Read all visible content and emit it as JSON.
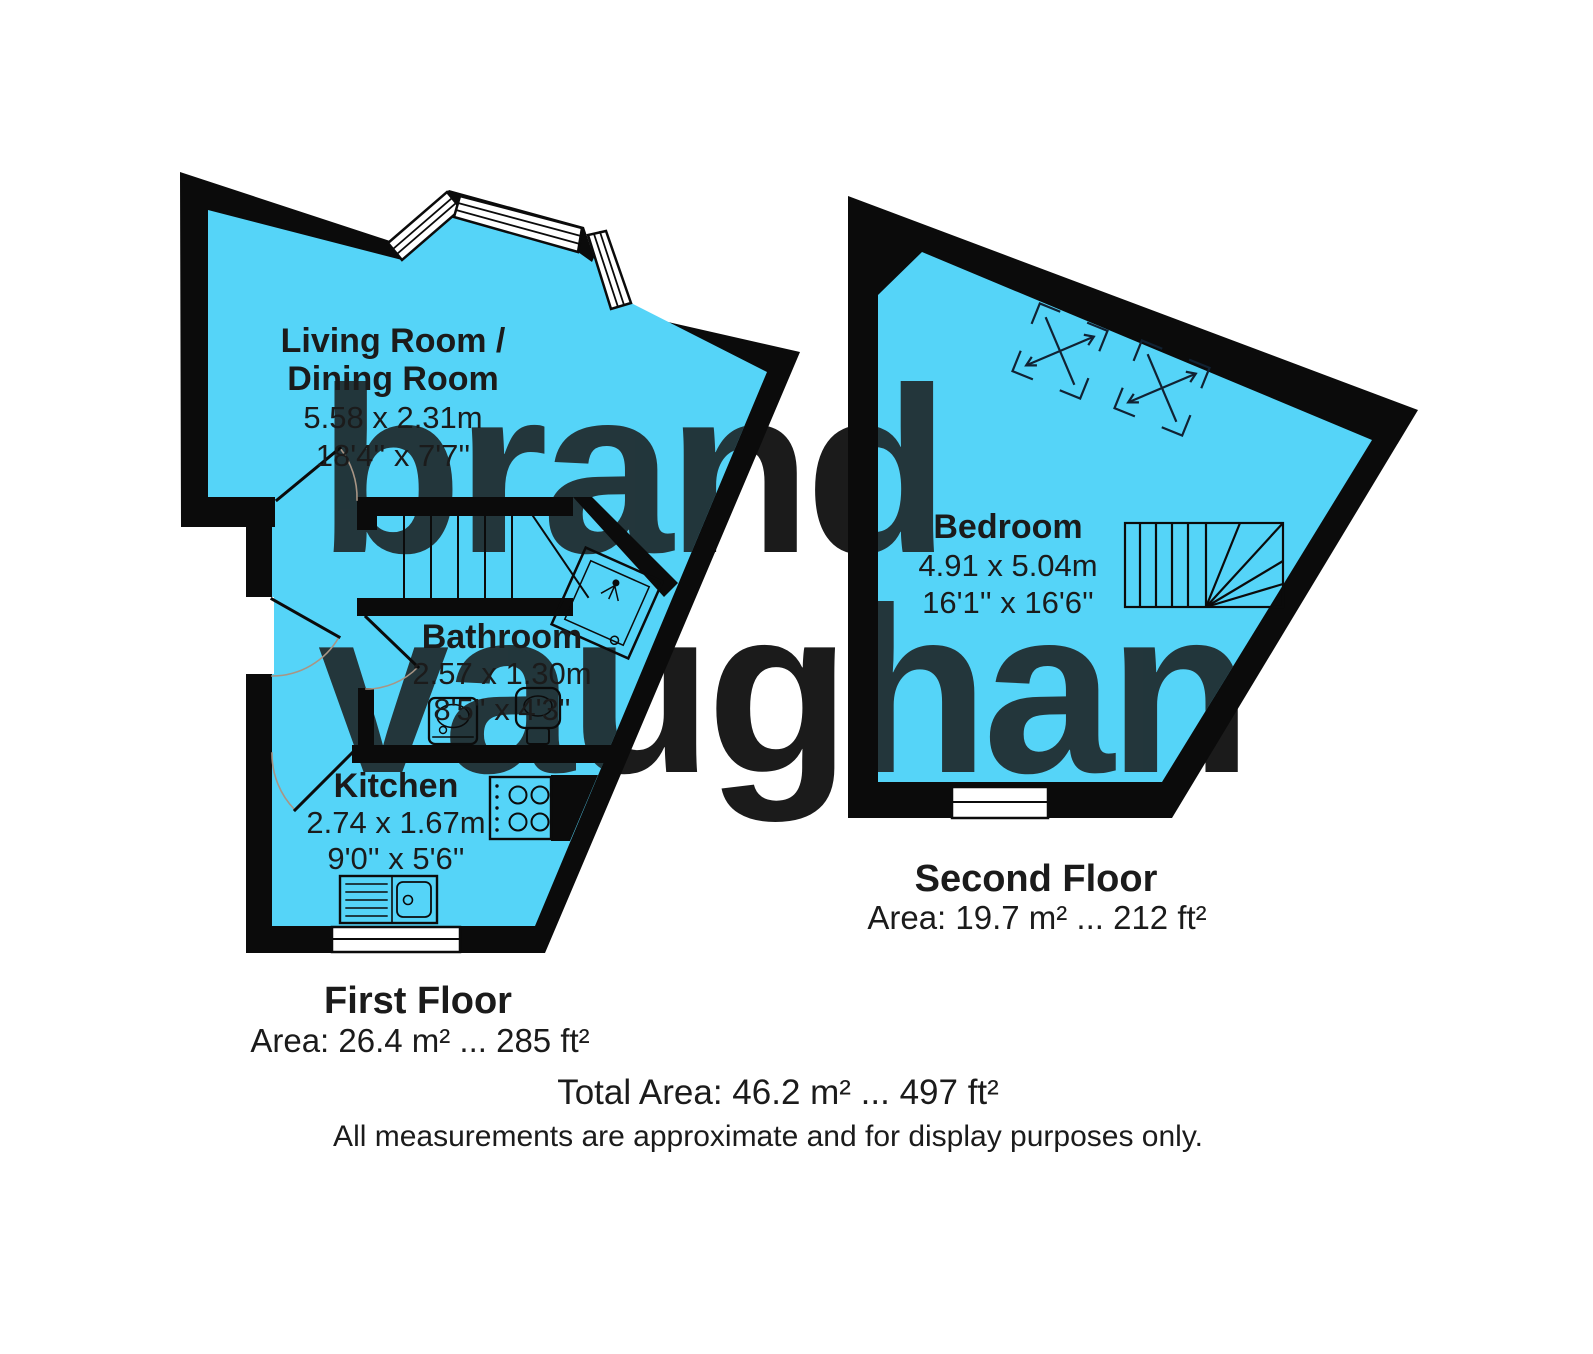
{
  "watermark": {
    "line1": "brand",
    "line2": "vaughan"
  },
  "floors": {
    "first": {
      "title": "First Floor",
      "area": "Area: 26.4 m² ... 285 ft²",
      "rooms": {
        "living": {
          "name1": "Living Room /",
          "name2": "Dining Room",
          "dim_m": "5.58 x 2.31m",
          "dim_ft": "18'4'' x 7'7''"
        },
        "bathroom": {
          "name": "Bathroom",
          "dim_m": "2.57 x 1.30m",
          "dim_ft": "8'5'' x 4'3''"
        },
        "kitchen": {
          "name": "Kitchen",
          "dim_m": "2.74 x 1.67m",
          "dim_ft": "9'0'' x 5'6''"
        }
      }
    },
    "second": {
      "title": "Second Floor",
      "area": "Area: 19.7 m² ... 212 ft²",
      "rooms": {
        "bedroom": {
          "name": "Bedroom",
          "dim_m": "4.91 x 5.04m",
          "dim_ft": "16'1'' x 16'6''"
        }
      }
    }
  },
  "footer": {
    "total": "Total Area: 46.2 m² ... 497 ft²",
    "disclaimer": "All measurements are approximate and for display purposes only."
  },
  "colors": {
    "floor_fill": "#55d4f8",
    "wall": "#0b0b0b",
    "watermark_light": "#def2fc",
    "watermark_on_floor": "#85dffb"
  }
}
